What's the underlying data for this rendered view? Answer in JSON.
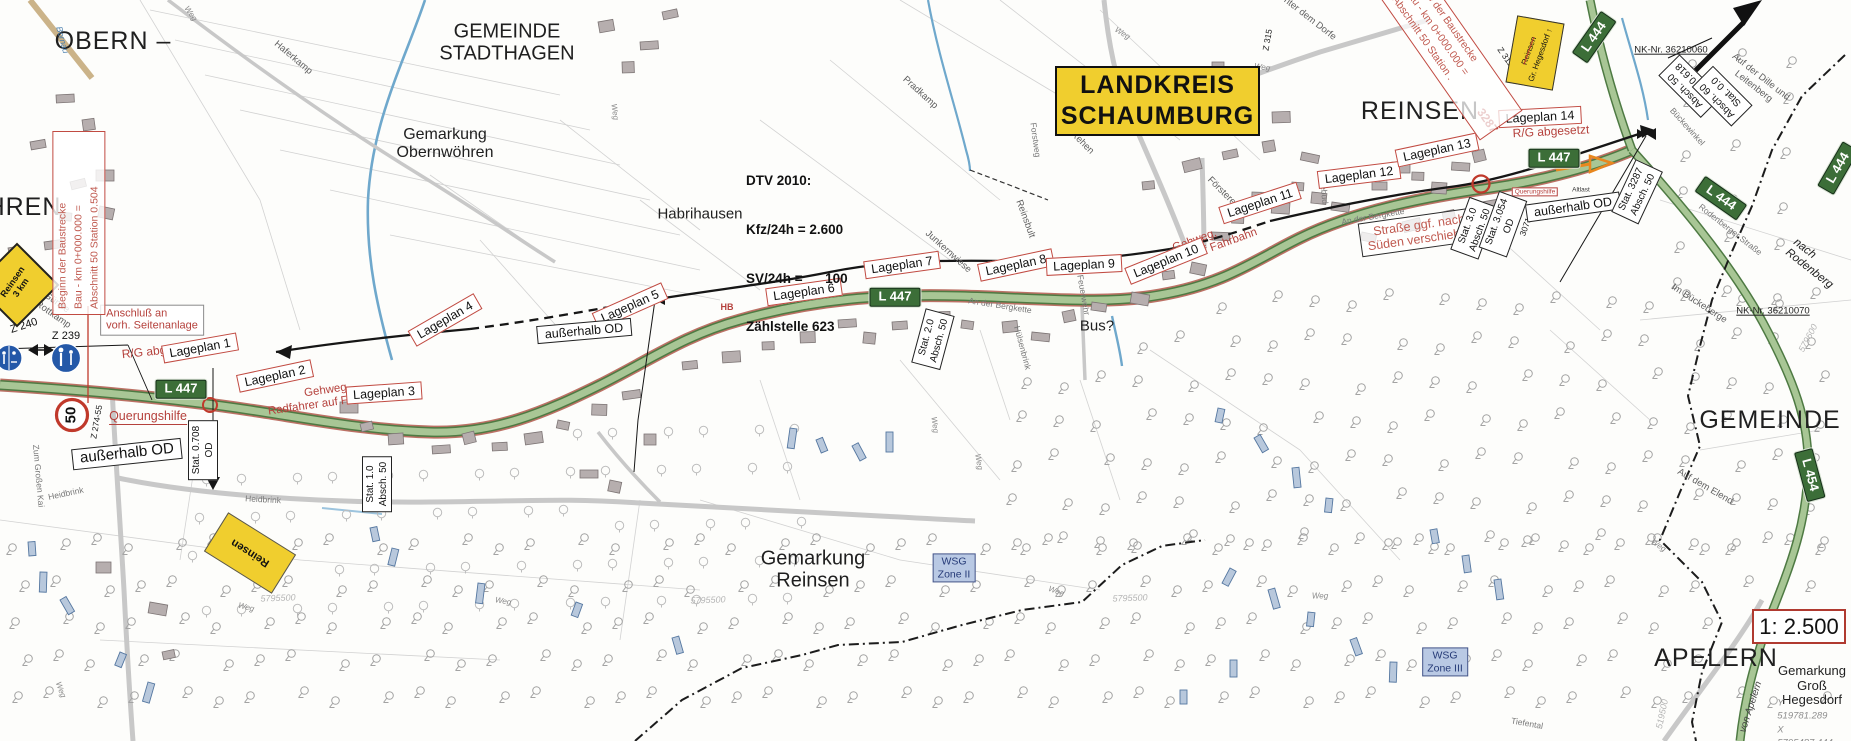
{
  "map": {
    "scale": "1: 2.500",
    "landkreis": {
      "line1": "LANDKREIS",
      "line2": "SCHAUMBURG"
    },
    "dtv": {
      "line1": "DTV 2010:",
      "line2": "Kfz/24h = 2.600",
      "line3": "SV/24h =      100",
      "line4": "Zählstelle 623"
    },
    "beginn_note": {
      "line1": "Beginn der Baustrecke",
      "line2": "Bau - km 0+000.000 =",
      "line3": "Abschnitt 50 Station 0.504"
    },
    "ende_note": {
      "line1": "Ende der Baustrecke",
      "line2": "Bau - km 0+000.000 =",
      "line3": "Abschnitt 50 Station ."
    },
    "colors": {
      "accent_red": "#c14b42",
      "sign_green": "#3c6e38",
      "sign_yellow": "#f0ce2e",
      "wsg_blue": "#b9c9e4",
      "road_green": "#a8c695",
      "water_blue": "#6fa8cc"
    },
    "labels": [
      {
        "text": "OBERN –",
        "cx": 113,
        "cy": 41,
        "cls": "big",
        "name": "label-obern"
      },
      {
        "text": "HREN",
        "cx": 24,
        "cy": 207,
        "cls": "big",
        "name": "label-wohren"
      },
      {
        "text": "GEMEINDE\nSTADTHAGEN",
        "cx": 507,
        "cy": 43,
        "cls": "big2",
        "name": "label-gemeinde-stadthagen"
      },
      {
        "text": "Gemarkung\nObernwöhren",
        "cx": 445,
        "cy": 144,
        "cls": "area",
        "name": "label-gemarkung-obernwoehren"
      },
      {
        "text": "Habrihausen",
        "cx": 700,
        "cy": 215,
        "cls": "area-s"
      },
      {
        "text": "Haferkamp",
        "cx": 293,
        "cy": 58,
        "rot": 40,
        "cls": "field"
      },
      {
        "text": "Pradkamp",
        "cx": 920,
        "cy": 93,
        "rot": 42,
        "cls": "field"
      },
      {
        "text": "Rehen",
        "cx": 1082,
        "cy": 143,
        "rot": 45,
        "cls": "field"
      },
      {
        "text": "Reinsbult",
        "cx": 1025,
        "cy": 219,
        "rot": 70,
        "cls": "field"
      },
      {
        "text": "Försterei",
        "cx": 1222,
        "cy": 192,
        "rot": 45,
        "cls": "field"
      },
      {
        "text": "Junkernwiese",
        "cx": 948,
        "cy": 252,
        "rot": 42,
        "cls": "field"
      },
      {
        "text": "REINSEN",
        "cx": 1420,
        "cy": 111,
        "cls": "big",
        "name": "label-reinsen"
      },
      {
        "text": "Unter dem Dorfe",
        "cx": 1307,
        "cy": 17,
        "rot": 38,
        "cls": "field"
      },
      {
        "text": "Forstweg",
        "cx": 1035,
        "cy": 140,
        "rot": 82,
        "cls": "street"
      },
      {
        "text": "Reitebud",
        "cx": 1323,
        "cy": 187,
        "rot": 84,
        "cls": "street"
      },
      {
        "text": "An der Bergkette",
        "cx": 1000,
        "cy": 306,
        "rot": 9,
        "cls": "street"
      },
      {
        "text": "An der Bergkette",
        "cx": 1373,
        "cy": 217,
        "rot": -10,
        "cls": "street"
      },
      {
        "text": "Hülsenbrink",
        "cx": 1022,
        "cy": 348,
        "rot": 75,
        "cls": "street"
      },
      {
        "text": "Feuerwehr",
        "cx": 1083,
        "cy": 295,
        "rot": 80,
        "cls": "street"
      },
      {
        "text": "Heidbrink",
        "cx": 66,
        "cy": 494,
        "rot": -12,
        "cls": "street"
      },
      {
        "text": "Heidbrink",
        "cx": 263,
        "cy": 500,
        "rot": 3,
        "cls": "street"
      },
      {
        "text": "Zum Großen Kai",
        "cx": 38,
        "cy": 476,
        "rot": 85,
        "cls": "street"
      },
      {
        "text": "Bus?",
        "cx": 1097,
        "cy": 327,
        "cls": "area-s",
        "name": "label-bus"
      },
      {
        "text": "Gemarkung\nReinsen",
        "cx": 813,
        "cy": 570,
        "cls": "big2",
        "name": "label-gemarkung-reinsen"
      },
      {
        "text": "GEMEINDE",
        "cx": 1770,
        "cy": 420,
        "cls": "big",
        "name": "label-gemeinde-right"
      },
      {
        "text": "APELERN",
        "cx": 1716,
        "cy": 658,
        "cls": "big",
        "name": "label-apelern"
      },
      {
        "text": "Gemarkung\nGroß\nHegesdorf",
        "cx": 1812,
        "cy": 686,
        "cls": "area-c",
        "name": "label-gemarkung-gross-hegesdorf"
      },
      {
        "text": "In der Günne\nund der Rottkamp",
        "cx": 42,
        "cy": 300,
        "rot": 35,
        "cls": "field"
      },
      {
        "text": "Im Bückeberge",
        "cx": 1699,
        "cy": 304,
        "rot": 33,
        "cls": "field"
      },
      {
        "text": "Auf der Dille und Leitenberg",
        "cx": 1757,
        "cy": 82,
        "rot": 38,
        "cls": "field"
      },
      {
        "text": "Bückewinkel",
        "cx": 1687,
        "cy": 127,
        "rot": 48,
        "cls": "street"
      },
      {
        "text": "Auf dem Elend",
        "cx": 1705,
        "cy": 487,
        "rot": 30,
        "cls": "field"
      },
      {
        "text": "nach Rodenberg",
        "cx": 1813,
        "cy": 264,
        "rot": 38,
        "cls": "ital"
      },
      {
        "text": "Rodenberger Straße",
        "cx": 1730,
        "cy": 230,
        "rot": 38,
        "cls": "street"
      },
      {
        "text": "von Apelern",
        "cx": 1751,
        "cy": 707,
        "rot": -72,
        "cls": "ital-s"
      },
      {
        "text": "Tiefental",
        "cx": 1527,
        "cy": 724,
        "rot": 10,
        "cls": "street"
      },
      {
        "text": "Altlast",
        "cx": 1581,
        "cy": 190,
        "cls": "tiny"
      },
      {
        "text": "Bornau",
        "cx": 62,
        "cy": 40,
        "rot": 75,
        "cls": "blue-t"
      },
      {
        "text": "NK-Nr. 36210060",
        "cx": 1671,
        "cy": 51,
        "cls": "nk",
        "name": "label-nk-36210060"
      },
      {
        "text": "NK-Nr. 36210070",
        "cx": 1773,
        "cy": 312,
        "cls": "nk",
        "name": "label-nk-36210070"
      },
      {
        "text": "Y 519781.289\nX 5795487.444",
        "cx": 1805,
        "cy": 723,
        "cls": "coord",
        "name": "label-coordinates"
      },
      {
        "text": "519500",
        "cx": 1662,
        "cy": 714,
        "rot": -78,
        "cls": "faint"
      },
      {
        "text": "579600",
        "cx": 1808,
        "cy": 338,
        "rot": -62,
        "cls": "faint"
      },
      {
        "text": "5795500",
        "cx": 278,
        "cy": 598,
        "rot": -2,
        "cls": "faint"
      },
      {
        "text": "5795500",
        "cx": 708,
        "cy": 600,
        "rot": -2,
        "cls": "faint"
      },
      {
        "text": "5795500",
        "cx": 1130,
        "cy": 598,
        "rot": -2,
        "cls": "faint"
      },
      {
        "text": "Z 240",
        "cx": 24,
        "cy": 326,
        "rot": -18,
        "cls": "zlbl"
      },
      {
        "text": "Z 239",
        "cx": 66,
        "cy": 336,
        "cls": "zlbl"
      },
      {
        "text": "Z 274-55",
        "cx": 97,
        "cy": 422,
        "rot": -80,
        "cls": "zlbl-s"
      },
      {
        "text": "Z 310",
        "cx": 221,
        "cy": 537,
        "rot": -78,
        "cls": "zlbl-s"
      },
      {
        "text": "Z 311",
        "cx": 1505,
        "cy": 57,
        "rot": 55,
        "cls": "zlbl-s"
      },
      {
        "text": "Z 315",
        "cx": 1268,
        "cy": 40,
        "rot": -80,
        "cls": "zlbl-s"
      },
      {
        "text": "3071",
        "cx": 1526,
        "cy": 227,
        "rot": -70,
        "cls": "zlbl-s"
      },
      {
        "text": "HB",
        "cx": 727,
        "cy": 307,
        "cls": "red-s"
      },
      {
        "text": "Querungshilfe",
        "cx": 148,
        "cy": 417,
        "cls": "red-u",
        "name": "label-querungshilfe-left"
      },
      {
        "text": "Querungshilfe",
        "cx": 1535,
        "cy": 192,
        "cls": "queru-box",
        "name": "label-querungshilfe-right"
      },
      {
        "text": "R/G abgesetzt",
        "cx": 160,
        "cy": 351,
        "rot": -6,
        "cls": "red-n"
      },
      {
        "text": "R/G abgesetzt",
        "cx": 1551,
        "cy": 132,
        "rot": -3,
        "cls": "red-n"
      },
      {
        "text": "Gehweg,\nRadfahrer auf Fahrbahn",
        "cx": 328,
        "cy": 397,
        "rot": -8,
        "cls": "red-nc"
      },
      {
        "text": "Gehweg,\nRadfahrer auf Fahrbahn",
        "cx": 1197,
        "cy": 247,
        "rot": -20,
        "cls": "red-nc"
      },
      {
        "text": "3287",
        "cx": 1487,
        "cy": 121,
        "rot": 55,
        "cls": "red-b"
      },
      {
        "text": "50",
        "cx": 72,
        "cy": 415,
        "rot": -90,
        "cls": "spd",
        "name": "speed-limit-50-sign-label"
      },
      {
        "text": "Weg",
        "cx": 190,
        "cy": 14,
        "rot": 55,
        "cls": "wg"
      },
      {
        "text": "Weg",
        "cx": 614,
        "cy": 112,
        "rot": 82,
        "cls": "wg"
      },
      {
        "text": "Weg",
        "cx": 1122,
        "cy": 34,
        "rot": 32,
        "cls": "wg"
      },
      {
        "text": "Weg",
        "cx": 1262,
        "cy": 68,
        "rot": 8,
        "cls": "wg"
      },
      {
        "text": "Weg",
        "cx": 934,
        "cy": 425,
        "rot": 82,
        "cls": "wg"
      },
      {
        "text": "Weg",
        "cx": 1056,
        "cy": 592,
        "rot": 20,
        "cls": "wg"
      },
      {
        "text": "Weg",
        "cx": 1658,
        "cy": 546,
        "rot": 35,
        "cls": "wg"
      },
      {
        "text": "Weg",
        "cx": 1320,
        "cy": 597,
        "rot": 0,
        "cls": "wg"
      },
      {
        "text": "Weg",
        "cx": 503,
        "cy": 602,
        "rot": 10,
        "cls": "wg"
      },
      {
        "text": "Weg",
        "cx": 246,
        "cy": 608,
        "rot": 15,
        "cls": "wg"
      },
      {
        "text": "Weg",
        "cx": 60,
        "cy": 690,
        "rot": 70,
        "cls": "wg"
      },
      {
        "text": "Weg",
        "cx": 978,
        "cy": 462,
        "rot": 80,
        "cls": "wg"
      }
    ],
    "lageplan": [
      {
        "text": "Lageplan 1",
        "cx": 200,
        "cy": 348,
        "rot": -10
      },
      {
        "text": "Lageplan 2",
        "cx": 275,
        "cy": 376,
        "rot": -12
      },
      {
        "text": "Lageplan 3",
        "cx": 384,
        "cy": 393,
        "rot": -4
      },
      {
        "text": "Lageplan 4",
        "cx": 445,
        "cy": 320,
        "rot": -30
      },
      {
        "text": "Lageplan 5",
        "cx": 630,
        "cy": 306,
        "rot": -24
      },
      {
        "text": "Lageplan 6",
        "cx": 804,
        "cy": 292,
        "rot": -8
      },
      {
        "text": "Lageplan 7",
        "cx": 902,
        "cy": 265,
        "rot": -8
      },
      {
        "text": "Lageplan 8",
        "cx": 1016,
        "cy": 265,
        "rot": -12
      },
      {
        "text": "Lageplan 9",
        "cx": 1084,
        "cy": 265,
        "rot": -3
      },
      {
        "text": "Lageplan 10",
        "cx": 1166,
        "cy": 261,
        "rot": -22
      },
      {
        "text": "Lageplan 11",
        "cx": 1260,
        "cy": 203,
        "rot": -18
      },
      {
        "text": "Lageplan 12",
        "cx": 1359,
        "cy": 175,
        "rot": -7
      },
      {
        "text": "Lageplan 13",
        "cx": 1437,
        "cy": 150,
        "rot": -12
      },
      {
        "text": "Lageplan 14",
        "cx": 1540,
        "cy": 117,
        "rot": -3
      }
    ],
    "notes": [
      {
        "text": "außerhalb OD",
        "cx": 127,
        "cy": 454,
        "rot": -6,
        "cls": "od-box"
      },
      {
        "text": "außerhalb OD",
        "cx": 584,
        "cy": 331,
        "rot": -5,
        "cls": "od-box small"
      },
      {
        "text": "außerhalb OD",
        "cx": 1573,
        "cy": 207,
        "rot": -8,
        "cls": "od-box small"
      },
      {
        "text": "Anschluß an\nvorh. Seitenanlage",
        "cx": 152,
        "cy": 320,
        "rot": 0,
        "cls": "anschluss"
      },
      {
        "text": "Straße ggf. nach\nSüden verschieben",
        "cx": 1420,
        "cy": 232,
        "rot": -8,
        "cls": "strasse-note"
      }
    ],
    "stat_boxes": [
      {
        "lines": [
          "Stat. 0.708",
          "OD"
        ],
        "cx": 203,
        "cy": 450,
        "rot": -90
      },
      {
        "lines": [
          "Stat. 1.0",
          "Absch. 50"
        ],
        "cx": 377,
        "cy": 484,
        "rot": -90
      },
      {
        "lines": [
          "Stat. 2.0",
          "Absch. 50"
        ],
        "cx": 933,
        "cy": 339,
        "rot": -75
      },
      {
        "lines": [
          "Stat. 3.0",
          "Absch. 50"
        ],
        "cx": 1474,
        "cy": 228,
        "rot": -70
      },
      {
        "lines": [
          "Stat. 3.054",
          "OD"
        ],
        "cx": 1503,
        "cy": 224,
        "rot": -70
      },
      {
        "lines": [
          "Stat. 3287",
          "Absch. 50"
        ],
        "cx": 1637,
        "cy": 192,
        "rot": -65
      },
      {
        "lines": [
          "Absch. 50",
          "Stat. 0.618"
        ],
        "cx": 1690,
        "cy": 86,
        "rot": -135
      },
      {
        "lines": [
          "Absch. 60",
          "Stat. 0.0"
        ],
        "cx": 1722,
        "cy": 96,
        "rot": -135
      }
    ],
    "road_signs": [
      {
        "text": "L 447",
        "cx": 181,
        "cy": 389,
        "rot": 0
      },
      {
        "text": "L 447",
        "cx": 895,
        "cy": 297,
        "rot": 0
      },
      {
        "text": "L 447",
        "cx": 1554,
        "cy": 158,
        "rot": 0
      },
      {
        "text": "L 444",
        "cx": 1594,
        "cy": 37,
        "rot": -55
      },
      {
        "text": "L 444",
        "cx": 1721,
        "cy": 198,
        "rot": 35
      },
      {
        "text": "L 444",
        "cx": 1838,
        "cy": 168,
        "rot": -60
      },
      {
        "text": "L 454",
        "cx": 1810,
        "cy": 475,
        "rot": 75
      }
    ],
    "wsg": [
      {
        "text": "WSG\nZone II",
        "cx": 954,
        "cy": 568
      },
      {
        "text": "WSG\nZone III",
        "cx": 1445,
        "cy": 662
      }
    ],
    "yellow_signs": {
      "diamond_text": "Reinsen\n3 km",
      "rect_text": "Reinsen",
      "dir_line1": "Reinsen",
      "dir_line2": "Gr. Hegesdorf",
      "dir_arrow": "↑"
    }
  }
}
